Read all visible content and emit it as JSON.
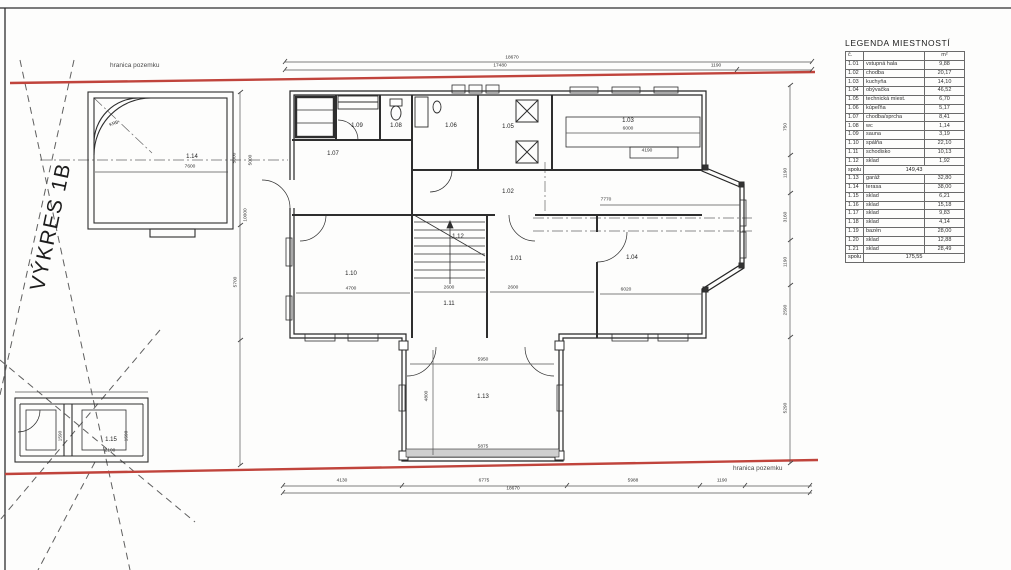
{
  "sheet": {
    "label": "VÝKRES 1B",
    "boundary_top": "hranica pozemku",
    "boundary_bottom": "hranica pozemku"
  },
  "colors": {
    "boundary_red": "#c0443c",
    "line_dark": "#2e2e2e",
    "dim_gray": "#555555"
  },
  "legend": {
    "title": "LEGENDA MIESTNOSTÍ",
    "header": {
      "no": "č.",
      "name": "",
      "area": "m²"
    },
    "rows": [
      {
        "no": "1.01",
        "name": "vstupná hala",
        "area": "9,88"
      },
      {
        "no": "1.02",
        "name": "chodba",
        "area": "20,17"
      },
      {
        "no": "1.03",
        "name": "kuchyňa",
        "area": "14,10"
      },
      {
        "no": "1.04",
        "name": "obývačka",
        "area": "46,52"
      },
      {
        "no": "1.05",
        "name": "technická miest.",
        "area": "6,70"
      },
      {
        "no": "1.06",
        "name": "kúpeľňa",
        "area": "5,17"
      },
      {
        "no": "1.07",
        "name": "chodba/sprcha",
        "area": "8,41"
      },
      {
        "no": "1.08",
        "name": "wc",
        "area": "1,14"
      },
      {
        "no": "1.09",
        "name": "sauna",
        "area": "3,19"
      },
      {
        "no": "1.10",
        "name": "spálňa",
        "area": "22,10"
      },
      {
        "no": "1.11",
        "name": "schodisko",
        "area": "10,13"
      },
      {
        "no": "1.12",
        "name": "sklad",
        "area": "1,92"
      }
    ],
    "subtotal": {
      "label": "spolu",
      "value": "149,43"
    },
    "rows2": [
      {
        "no": "1.13",
        "name": "garáž",
        "area": "32,80"
      },
      {
        "no": "1.14",
        "name": "terasa",
        "area": "38,00"
      },
      {
        "no": "1.15",
        "name": "sklad",
        "area": "6,21"
      },
      {
        "no": "1.16",
        "name": "sklad",
        "area": "15,18"
      },
      {
        "no": "1.17",
        "name": "sklad",
        "area": "9,83"
      },
      {
        "no": "1.18",
        "name": "sklad",
        "area": "4,14"
      },
      {
        "no": "1.19",
        "name": "bazén",
        "area": "28,00"
      },
      {
        "no": "1.20",
        "name": "sklad",
        "area": "12,88"
      },
      {
        "no": "1.21",
        "name": "sklad",
        "area": "28,49"
      }
    ],
    "total": {
      "label": "spolu",
      "value": "175,55"
    }
  },
  "plan": {
    "room_labels": [
      {
        "t": "1.14",
        "x": 192,
        "y": 157
      },
      {
        "t": "KRB",
        "x": 114,
        "y": 124,
        "r": -20,
        "s": 4.5
      },
      {
        "t": "1.09",
        "x": 357,
        "y": 126
      },
      {
        "t": "1.08",
        "x": 396,
        "y": 126
      },
      {
        "t": "1.06",
        "x": 451,
        "y": 126
      },
      {
        "t": "1.07",
        "x": 333,
        "y": 154
      },
      {
        "t": "1.05",
        "x": 508,
        "y": 127
      },
      {
        "t": "1.03",
        "x": 628,
        "y": 121
      },
      {
        "t": "1.02",
        "x": 508,
        "y": 192
      },
      {
        "t": "1.10",
        "x": 351,
        "y": 274
      },
      {
        "t": "1.12",
        "x": 458,
        "y": 237
      },
      {
        "t": "1.11",
        "x": 449,
        "y": 304
      },
      {
        "t": "1.01",
        "x": 516,
        "y": 259
      },
      {
        "t": "1.04",
        "x": 632,
        "y": 258
      },
      {
        "t": "1.13",
        "x": 483,
        "y": 397
      },
      {
        "t": "1.15",
        "x": 111,
        "y": 440
      }
    ],
    "dim_labels": [
      {
        "t": "18670",
        "x": 512,
        "y": 59
      },
      {
        "t": "17480",
        "x": 500,
        "y": 67
      },
      {
        "t": "1190",
        "x": 716,
        "y": 67
      },
      {
        "t": "7600",
        "x": 190,
        "y": 168
      },
      {
        "t": "5000",
        "x": 252,
        "y": 160,
        "r": -90
      },
      {
        "t": "5000",
        "x": 236,
        "y": 158,
        "r": -90
      },
      {
        "t": "10000",
        "x": 247,
        "y": 215,
        "r": -90
      },
      {
        "t": "5700",
        "x": 237,
        "y": 282,
        "r": -90
      },
      {
        "t": "6000",
        "x": 628,
        "y": 130
      },
      {
        "t": "4190",
        "x": 647,
        "y": 152
      },
      {
        "t": "7770",
        "x": 606,
        "y": 201
      },
      {
        "t": "6020",
        "x": 626,
        "y": 291
      },
      {
        "t": "4700",
        "x": 351,
        "y": 290
      },
      {
        "t": "2600",
        "x": 449,
        "y": 289
      },
      {
        "t": "2600",
        "x": 513,
        "y": 289
      },
      {
        "t": "5950",
        "x": 483,
        "y": 361
      },
      {
        "t": "5875",
        "x": 483,
        "y": 448
      },
      {
        "t": "4800",
        "x": 428,
        "y": 396,
        "r": -90
      },
      {
        "t": "2100",
        "x": 110,
        "y": 452
      },
      {
        "t": "1590",
        "x": 62,
        "y": 436,
        "r": -90
      },
      {
        "t": "1590",
        "x": 128,
        "y": 436,
        "r": -90
      },
      {
        "t": "4130",
        "x": 342,
        "y": 482
      },
      {
        "t": "6775",
        "x": 484,
        "y": 482
      },
      {
        "t": "5988",
        "x": 633,
        "y": 482
      },
      {
        "t": "1190",
        "x": 722,
        "y": 482
      },
      {
        "t": "18670",
        "x": 513,
        "y": 490
      },
      {
        "t": "750",
        "x": 787,
        "y": 127,
        "r": -90
      },
      {
        "t": "1190",
        "x": 787,
        "y": 173,
        "r": -90
      },
      {
        "t": "3160",
        "x": 787,
        "y": 217,
        "r": -90
      },
      {
        "t": "1190",
        "x": 787,
        "y": 262,
        "r": -90
      },
      {
        "t": "2590",
        "x": 787,
        "y": 310,
        "r": -90
      },
      {
        "t": "5290",
        "x": 787,
        "y": 408,
        "r": -90
      }
    ]
  }
}
